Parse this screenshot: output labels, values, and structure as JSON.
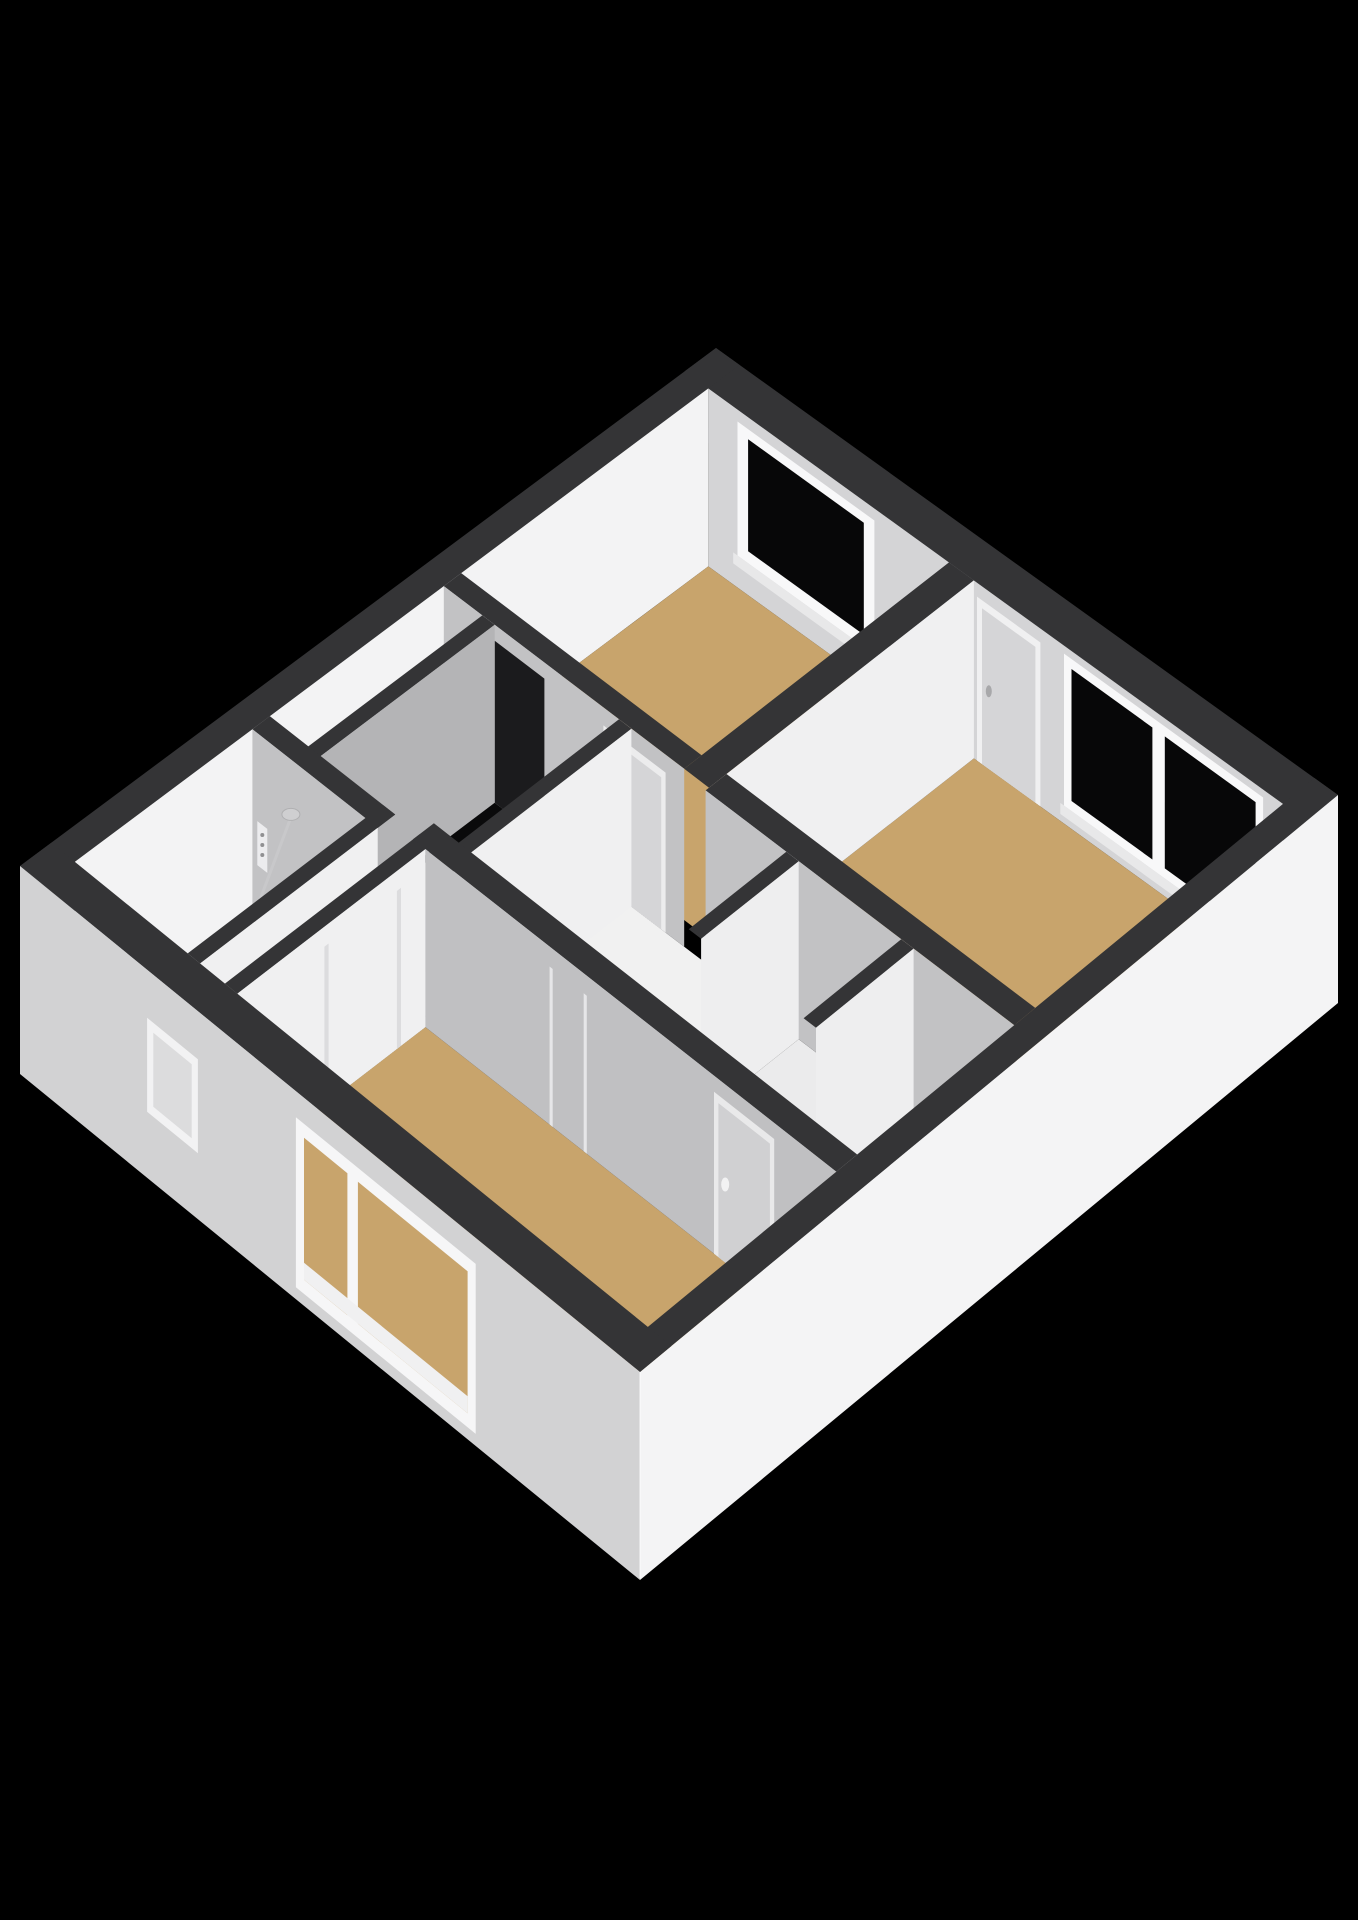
{
  "scene": {
    "kind": "3d-isometric-floorplan-render",
    "canvas": {
      "width": 1358,
      "height": 1920
    },
    "background": "#000000"
  },
  "colors": {
    "cap": "#343436",
    "faceTR": "#d4d4d6",
    "faceTL": "#f3f3f4",
    "faceDL": "#c2c2c4",
    "faceDLdark": "#b4b4b6",
    "faceDR": "#f0f0f1",
    "extBL": "#d2d2d3",
    "extBR": "#f4f4f5",
    "floorTan": "#c8a46c",
    "floorWhite": "#f1f1f1",
    "floorCloset": "#ebebec",
    "glass": "#070708",
    "frame": "#f8f8f9",
    "sill": "#e8e8e9",
    "doorLeaf": "#d5d5d7",
    "void": "#0a0a0b"
  },
  "projection": {
    "corner_top": [
      716,
      348
    ],
    "corner_right": [
      1338,
      795
    ],
    "corner_bottom": [
      640,
      1372
    ],
    "corner_left": [
      20,
      866
    ],
    "floor_drop": 178,
    "facade_drop": 208
  },
  "rooms": [
    {
      "name": "bedroom-top",
      "floor": "tan",
      "features": [
        "window-top-right-wall"
      ]
    },
    {
      "name": "bedroom-right-large",
      "floor": "tan",
      "features": [
        "door-top-right-wall",
        "large-window-top-right-wall"
      ]
    },
    {
      "name": "bedroom-bottom",
      "floor": "tan",
      "features": [
        "large-window-bottom-left-facade",
        "door-top-wall",
        "door-left-wall"
      ]
    },
    {
      "name": "bathroom",
      "floor": "white",
      "features": [
        "shower-head",
        "shower-drain",
        "shower-controls",
        "glass-partition"
      ]
    },
    {
      "name": "landing-hall",
      "floor": "white",
      "features": [
        "stairwell-opening",
        "stairs",
        "cupboard",
        "small-window-bottom-left-facade"
      ]
    },
    {
      "name": "closet-left",
      "floor": "white",
      "features": []
    },
    {
      "name": "closet-right",
      "floor": "white",
      "features": []
    }
  ],
  "elements": [
    {
      "type": "cap",
      "name": "exterior-wall-top-right-cap",
      "rect": [
        0,
        0,
        1,
        0.045
      ]
    },
    {
      "type": "faceDL",
      "name": "exterior-wall-top-right-inner-face",
      "a1": 0.038,
      "a2": 0.962,
      "b": 0.045,
      "drop": 178,
      "color": "faceTR"
    },
    {
      "type": "quadDL",
      "name": "top-room-window-frame",
      "a1": 0.085,
      "a2": 0.305,
      "b": 0.045,
      "dy1": 12,
      "dy2": 146,
      "color": "frame"
    },
    {
      "type": "quadDL",
      "name": "top-room-window-glass",
      "a1": 0.102,
      "a2": 0.288,
      "b": 0.045,
      "dy1": 22,
      "dy2": 134,
      "color": "glass"
    },
    {
      "type": "quadDL",
      "name": "top-room-window-sill",
      "a1": 0.078,
      "a2": 0.312,
      "b": 0.045,
      "dy1": 146,
      "dy2": 157,
      "color": "sill"
    },
    {
      "type": "quadDL",
      "name": "big-room-door-frame",
      "a1": 0.47,
      "a2": 0.572,
      "b": 0.045,
      "dy1": 14,
      "dy2": 178,
      "color": "faceDR"
    },
    {
      "type": "quadDL",
      "name": "big-room-door-leaf",
      "a1": 0.478,
      "a2": 0.564,
      "b": 0.045,
      "dy1": 22,
      "dy2": 178,
      "color": "doorLeaf"
    },
    {
      "type": "ellipse",
      "name": "big-room-door-handle",
      "a": 0.489,
      "b": 0.045,
      "dy": 100,
      "rx": 3,
      "ry": 6,
      "fill": "#a8a8aa"
    },
    {
      "type": "quadDL",
      "name": "big-room-window-frame",
      "a1": 0.61,
      "a2": 0.93,
      "b": 0.045,
      "dy1": 8,
      "dy2": 160,
      "color": "frame"
    },
    {
      "type": "quadDL",
      "name": "big-room-window-glass-left",
      "a1": 0.622,
      "a2": 0.752,
      "b": 0.045,
      "dy1": 18,
      "dy2": 150,
      "color": "glass"
    },
    {
      "type": "quadDL",
      "name": "big-room-window-glass-right",
      "a1": 0.772,
      "a2": 0.918,
      "b": 0.045,
      "dy1": 18,
      "dy2": 150,
      "color": "glass"
    },
    {
      "type": "quadDL",
      "name": "big-room-window-sill",
      "a1": 0.604,
      "a2": 0.936,
      "b": 0.045,
      "dy1": 160,
      "dy2": 171,
      "color": "sill"
    },
    {
      "type": "cap",
      "name": "exterior-wall-top-left-cap",
      "rect": [
        0,
        0,
        0.038,
        1
      ]
    },
    {
      "type": "faceDR",
      "name": "exterior-wall-top-left-inner-face",
      "a": 0.038,
      "b1": 0.045,
      "b2": 0.955,
      "drop": 178,
      "color": "faceTL"
    },
    {
      "type": "floor",
      "name": "top-room-floor",
      "rect": [
        0.038,
        0.045,
        0.425,
        0.4
      ],
      "color": "floorTan"
    },
    {
      "type": "floor",
      "name": "big-room-floor",
      "rect": [
        0.465,
        0.045,
        0.962,
        0.4
      ],
      "color": "floorTan"
    },
    {
      "type": "floor",
      "name": "landing-floor",
      "rect": [
        0.038,
        0.425,
        0.595,
        0.675
      ],
      "color": "floorWhite"
    },
    {
      "type": "floor",
      "name": "hall-front-of-closets-floor",
      "rect": [
        0.595,
        0.57,
        0.962,
        0.655
      ],
      "color": "floorWhite"
    },
    {
      "type": "floor",
      "name": "closet-left-floor",
      "rect": [
        0.615,
        0.43,
        0.78,
        0.57
      ],
      "color": "floorCloset"
    },
    {
      "type": "floor",
      "name": "closet-right-floor",
      "rect": [
        0.8,
        0.43,
        0.962,
        0.57
      ],
      "color": "floorCloset"
    },
    {
      "type": "floor",
      "name": "hall-narrow-floor",
      "rect": [
        0.22,
        0.675,
        0.3,
        0.955
      ],
      "color": "floorWhite"
    },
    {
      "type": "floor",
      "name": "bathroom-floor",
      "rect": [
        0.038,
        0.7,
        0.22,
        0.955
      ],
      "color": "floorWhite"
    },
    {
      "type": "floor",
      "name": "bottom-room-floor",
      "rect": [
        0.3,
        0.685,
        0.962,
        0.955
      ],
      "color": "floorTan"
    },
    {
      "type": "plan-poly",
      "name": "stairwell-void",
      "dy": 120,
      "color": "void",
      "pts": [
        [
          0.13,
          0.45
        ],
        [
          0.31,
          0.45
        ],
        [
          0.31,
          0.6
        ],
        [
          0.25,
          0.6
        ],
        [
          0.25,
          0.66
        ],
        [
          0.13,
          0.66
        ]
      ]
    },
    {
      "type": "plan-poly",
      "name": "stair-step-1",
      "dy": 148,
      "color": "#f4f4f5",
      "pts": [
        [
          0.13,
          0.56
        ],
        [
          0.22,
          0.56
        ],
        [
          0.22,
          0.62
        ],
        [
          0.13,
          0.62
        ]
      ]
    },
    {
      "type": "plan-poly",
      "name": "stair-step-2",
      "dy": 162,
      "color": "#ececed",
      "pts": [
        [
          0.14,
          0.585
        ],
        [
          0.23,
          0.585
        ],
        [
          0.23,
          0.645
        ],
        [
          0.14,
          0.645
        ]
      ]
    },
    {
      "type": "plan-poly",
      "name": "stair-step-3",
      "dy": 176,
      "color": "#e2e2e3",
      "pts": [
        [
          0.15,
          0.61
        ],
        [
          0.245,
          0.61
        ],
        [
          0.245,
          0.665
        ],
        [
          0.15,
          0.665
        ]
      ]
    },
    {
      "type": "cap",
      "name": "wall-top-room-right-cap",
      "rect": [
        0.425,
        0.045,
        0.465,
        0.425
      ]
    },
    {
      "type": "faceDR",
      "name": "wall-top-room-right-face",
      "a": 0.465,
      "b1": 0.045,
      "b2": 0.425,
      "drop": 178,
      "color": "faceDR"
    },
    {
      "type": "cap",
      "name": "wall-top-room-bottom-cap",
      "rect": [
        0.038,
        0.4,
        0.425,
        0.425
      ]
    },
    {
      "type": "faceDL",
      "name": "wall-top-room-bottom-face",
      "a1": 0.038,
      "a2": 0.425,
      "b": 0.425,
      "drop": 178,
      "color": "faceDL"
    },
    {
      "type": "quadDL",
      "name": "stair-doorway-opening",
      "a1": 0.12,
      "a2": 0.2,
      "b": 0.425,
      "dy1": 16,
      "dy2": 178,
      "color": "#1b1b1d"
    },
    {
      "type": "quadDL",
      "name": "top-room-door-frame",
      "a1": 0.295,
      "a2": 0.395,
      "b": 0.425,
      "dy1": 18,
      "dy2": 178,
      "color": "#ececed"
    },
    {
      "type": "quadDL",
      "name": "top-room-door-leaf",
      "a1": 0.302,
      "a2": 0.388,
      "b": 0.425,
      "dy1": 26,
      "dy2": 178,
      "color": "doorLeaf"
    },
    {
      "type": "cap",
      "name": "stair-enclosure-left-wall-cap",
      "rect": [
        0.1,
        0.425,
        0.12,
        0.68
      ]
    },
    {
      "type": "faceDR",
      "name": "stair-enclosure-left-wall-face",
      "a": 0.12,
      "b1": 0.425,
      "b2": 0.68,
      "drop": 178,
      "color": "faceDLdark"
    },
    {
      "type": "cap",
      "name": "stair-enclosure-right-wall-cap",
      "rect": [
        0.32,
        0.425,
        0.34,
        0.68
      ]
    },
    {
      "type": "faceDR",
      "name": "stair-enclosure-right-wall-face",
      "a": 0.34,
      "b1": 0.425,
      "b2": 0.68,
      "drop": 178,
      "color": "faceDR"
    },
    {
      "type": "cap",
      "name": "wall-big-room-bottom-cap",
      "rect": [
        0.465,
        0.4,
        0.962,
        0.43
      ]
    },
    {
      "type": "faceDL",
      "name": "wall-big-room-bottom-face",
      "a1": 0.465,
      "a2": 0.962,
      "b": 0.43,
      "drop": 178,
      "color": "faceDL"
    },
    {
      "type": "cap",
      "name": "closet-left-wall-cap",
      "rect": [
        0.595,
        0.43,
        0.615,
        0.57
      ]
    },
    {
      "type": "faceDR",
      "name": "closet-left-wall-face",
      "a": 0.615,
      "b1": 0.43,
      "b2": 0.57,
      "drop": 178,
      "color": "#eeeeef"
    },
    {
      "type": "cap",
      "name": "closet-divider-wall-cap",
      "rect": [
        0.78,
        0.43,
        0.8,
        0.57
      ]
    },
    {
      "type": "faceDR",
      "name": "closet-divider-wall-face",
      "a": 0.8,
      "b1": 0.43,
      "b2": 0.57,
      "drop": 178,
      "color": "#eeeeef"
    },
    {
      "type": "cap",
      "name": "wall-bathroom-top-cap",
      "rect": [
        0.038,
        0.675,
        0.24,
        0.7
      ]
    },
    {
      "type": "faceDL",
      "name": "wall-bathroom-top-face",
      "a1": 0.038,
      "a2": 0.24,
      "b": 0.7,
      "drop": 178,
      "color": "faceDL"
    },
    {
      "type": "ellipse",
      "name": "shower-tray",
      "a": 0.115,
      "b": 0.8,
      "dy": 168,
      "rx": 40,
      "ry": 24,
      "fill": "#e0e0e1",
      "stroke": "#c9c9cb",
      "sw": 2
    },
    {
      "type": "ellipse",
      "name": "shower-drain",
      "a": 0.115,
      "b": 0.8,
      "dy": 170,
      "rx": 7,
      "ry": 4,
      "fill": "#ababad"
    },
    {
      "type": "line",
      "name": "shower-head-stem",
      "p1": [
        0.1,
        0.7,
        58
      ],
      "p2": [
        0.113,
        0.775,
        130
      ],
      "color": "#c8c8ca",
      "w": 3
    },
    {
      "type": "ellipse",
      "name": "shower-head",
      "a": 0.1,
      "b": 0.7,
      "dy": 55,
      "rx": 9,
      "ry": 6,
      "fill": "#cfcfd1",
      "stroke": "#b0b0b2",
      "sw": 1
    },
    {
      "type": "quadDL",
      "name": "shower-controls-panel",
      "a1": 0.046,
      "a2": 0.062,
      "b": 0.7,
      "dy1": 88,
      "dy2": 132,
      "color": "#ececee"
    },
    {
      "type": "ellipse",
      "name": "shower-control-knob-1",
      "a": 0.054,
      "b": 0.7,
      "dy": 98,
      "rx": 2,
      "ry": 2,
      "fill": "#909092"
    },
    {
      "type": "ellipse",
      "name": "shower-control-knob-2",
      "a": 0.054,
      "b": 0.7,
      "dy": 108,
      "rx": 2,
      "ry": 2,
      "fill": "#909092"
    },
    {
      "type": "ellipse",
      "name": "shower-control-knob-3",
      "a": 0.054,
      "b": 0.7,
      "dy": 118,
      "rx": 2,
      "ry": 2,
      "fill": "#909092"
    },
    {
      "type": "line",
      "name": "shower-glass-partition",
      "p1": [
        0.038,
        0.775,
        172
      ],
      "p2": [
        0.22,
        0.775,
        172
      ],
      "color": "#e8e8e9",
      "w": 2,
      "opacity": 0.65
    },
    {
      "type": "cap",
      "name": "wall-bathroom-right-cap",
      "rect": [
        0.22,
        0.675,
        0.24,
        0.955
      ]
    },
    {
      "type": "faceDR",
      "name": "wall-bathroom-right-face",
      "a": 0.24,
      "b1": 0.7,
      "b2": 0.955,
      "drop": 178,
      "color": "faceDR"
    },
    {
      "type": "box",
      "name": "hall-cupboard-tall",
      "rect": [
        0.24,
        0.77,
        0.28,
        0.92
      ],
      "h": 130,
      "top": "#fbfbfb",
      "dr": "#ececee",
      "dl": "#d8d8da"
    },
    {
      "type": "box",
      "name": "hall-cupboard-low",
      "rect": [
        0.242,
        0.705,
        0.278,
        0.755
      ],
      "h": 78,
      "top": "#f7f7f8",
      "dr": "#e6e6e8",
      "dl": "#d2d2d4"
    },
    {
      "type": "cap",
      "name": "wall-bottom-room-left-cap",
      "rect": [
        0.28,
        0.675,
        0.3,
        0.955
      ]
    },
    {
      "type": "faceDR",
      "name": "wall-bottom-room-left-face",
      "a": 0.3,
      "b1": 0.685,
      "b2": 0.955,
      "drop": 178,
      "color": "faceDR"
    },
    {
      "type": "quadDR",
      "name": "bottom-room-left-door-frame-line-1",
      "a": 0.3,
      "b1": 0.72,
      "b2": 0.726,
      "dy1": 20,
      "dy2": 178,
      "color": "#dcdcde"
    },
    {
      "type": "quadDR",
      "name": "bottom-room-left-door-frame-line-2",
      "a": 0.3,
      "b1": 0.824,
      "b2": 0.83,
      "dy1": 20,
      "dy2": 178,
      "color": "#dcdcde"
    },
    {
      "type": "cap",
      "name": "wall-bottom-room-top-cap",
      "rect": [
        0.28,
        0.655,
        0.962,
        0.685
      ]
    },
    {
      "type": "faceDL",
      "name": "wall-bottom-room-top-face",
      "a1": 0.3,
      "a2": 0.962,
      "b": 0.685,
      "drop": 178,
      "color": "#c0c0c2"
    },
    {
      "type": "quadDL",
      "name": "hall-door-frame-line-1",
      "a1": 0.5,
      "a2": 0.505,
      "b": 0.685,
      "dy1": 20,
      "dy2": 178,
      "color": "#e6e6e8"
    },
    {
      "type": "quadDL",
      "name": "hall-door-frame-line-2",
      "a1": 0.555,
      "a2": 0.56,
      "b": 0.685,
      "dy1": 20,
      "dy2": 178,
      "color": "#e6e6e8"
    },
    {
      "type": "quadDL",
      "name": "bottom-room-door-frame",
      "a1": 0.765,
      "a2": 0.862,
      "b": 0.685,
      "dy1": 16,
      "dy2": 178,
      "color": "#e9e9ea"
    },
    {
      "type": "quadDL",
      "name": "bottom-room-door-leaf",
      "a1": 0.772,
      "a2": 0.855,
      "b": 0.685,
      "dy1": 24,
      "dy2": 178,
      "color": "#d0d0d2"
    },
    {
      "type": "ellipse",
      "name": "bottom-room-door-handle",
      "a": 0.783,
      "b": 0.685,
      "dy": 100,
      "rx": 4,
      "ry": 7,
      "fill": "#f2f2f3"
    },
    {
      "type": "cap",
      "name": "exterior-wall-bottom-right-cap",
      "rect": [
        0.962,
        0,
        1,
        1
      ]
    },
    {
      "type": "faceDR",
      "name": "exterior-facade-bottom-right",
      "a": 1,
      "b1": 0,
      "b2": 1,
      "drop": 208,
      "color": "extBR"
    },
    {
      "type": "cap",
      "name": "exterior-wall-bottom-left-cap",
      "rect": [
        0,
        0.955,
        1,
        1
      ]
    },
    {
      "type": "faceDL",
      "name": "exterior-facade-bottom-left",
      "a1": 0,
      "a2": 1,
      "b": 1,
      "drop": 208,
      "color": "extBL"
    },
    {
      "type": "quadDL",
      "name": "facade-small-window-frame",
      "a1": 0.205,
      "a2": 0.287,
      "b": 1,
      "dy1": 48,
      "dy2": 142,
      "color": "#f2f2f3"
    },
    {
      "type": "quadDL",
      "name": "facade-small-window-inner",
      "a1": 0.215,
      "a2": 0.277,
      "b": 1,
      "dy1": 58,
      "dy2": 132,
      "color": "#dcdcdd"
    },
    {
      "type": "quadDL",
      "name": "facade-large-window-frame",
      "a1": 0.445,
      "a2": 0.735,
      "b": 1,
      "dy1": 26,
      "dy2": 196,
      "color": "#f6f6f7"
    },
    {
      "type": "quadDL",
      "name": "facade-large-window-pane-left",
      "a1": 0.458,
      "a2": 0.528,
      "b": 1,
      "dy1": 40,
      "dy2": 182,
      "color": "floorTan"
    },
    {
      "type": "quadDL",
      "name": "facade-large-window-pane-right",
      "a1": 0.545,
      "a2": 0.722,
      "b": 1,
      "dy1": 40,
      "dy2": 182,
      "color": "floorTan"
    },
    {
      "type": "quadDL",
      "name": "facade-large-window-sill-band",
      "a1": 0.458,
      "a2": 0.722,
      "b": 1,
      "dy1": 165,
      "dy2": 182,
      "color": "#f0f0f1"
    },
    {
      "type": "line",
      "name": "building-near-corner-edge",
      "p1": [
        1,
        1,
        0
      ],
      "p2": [
        1,
        1,
        206
      ],
      "color": "#ffffff",
      "w": 1.5,
      "opacity": 0.55
    }
  ]
}
